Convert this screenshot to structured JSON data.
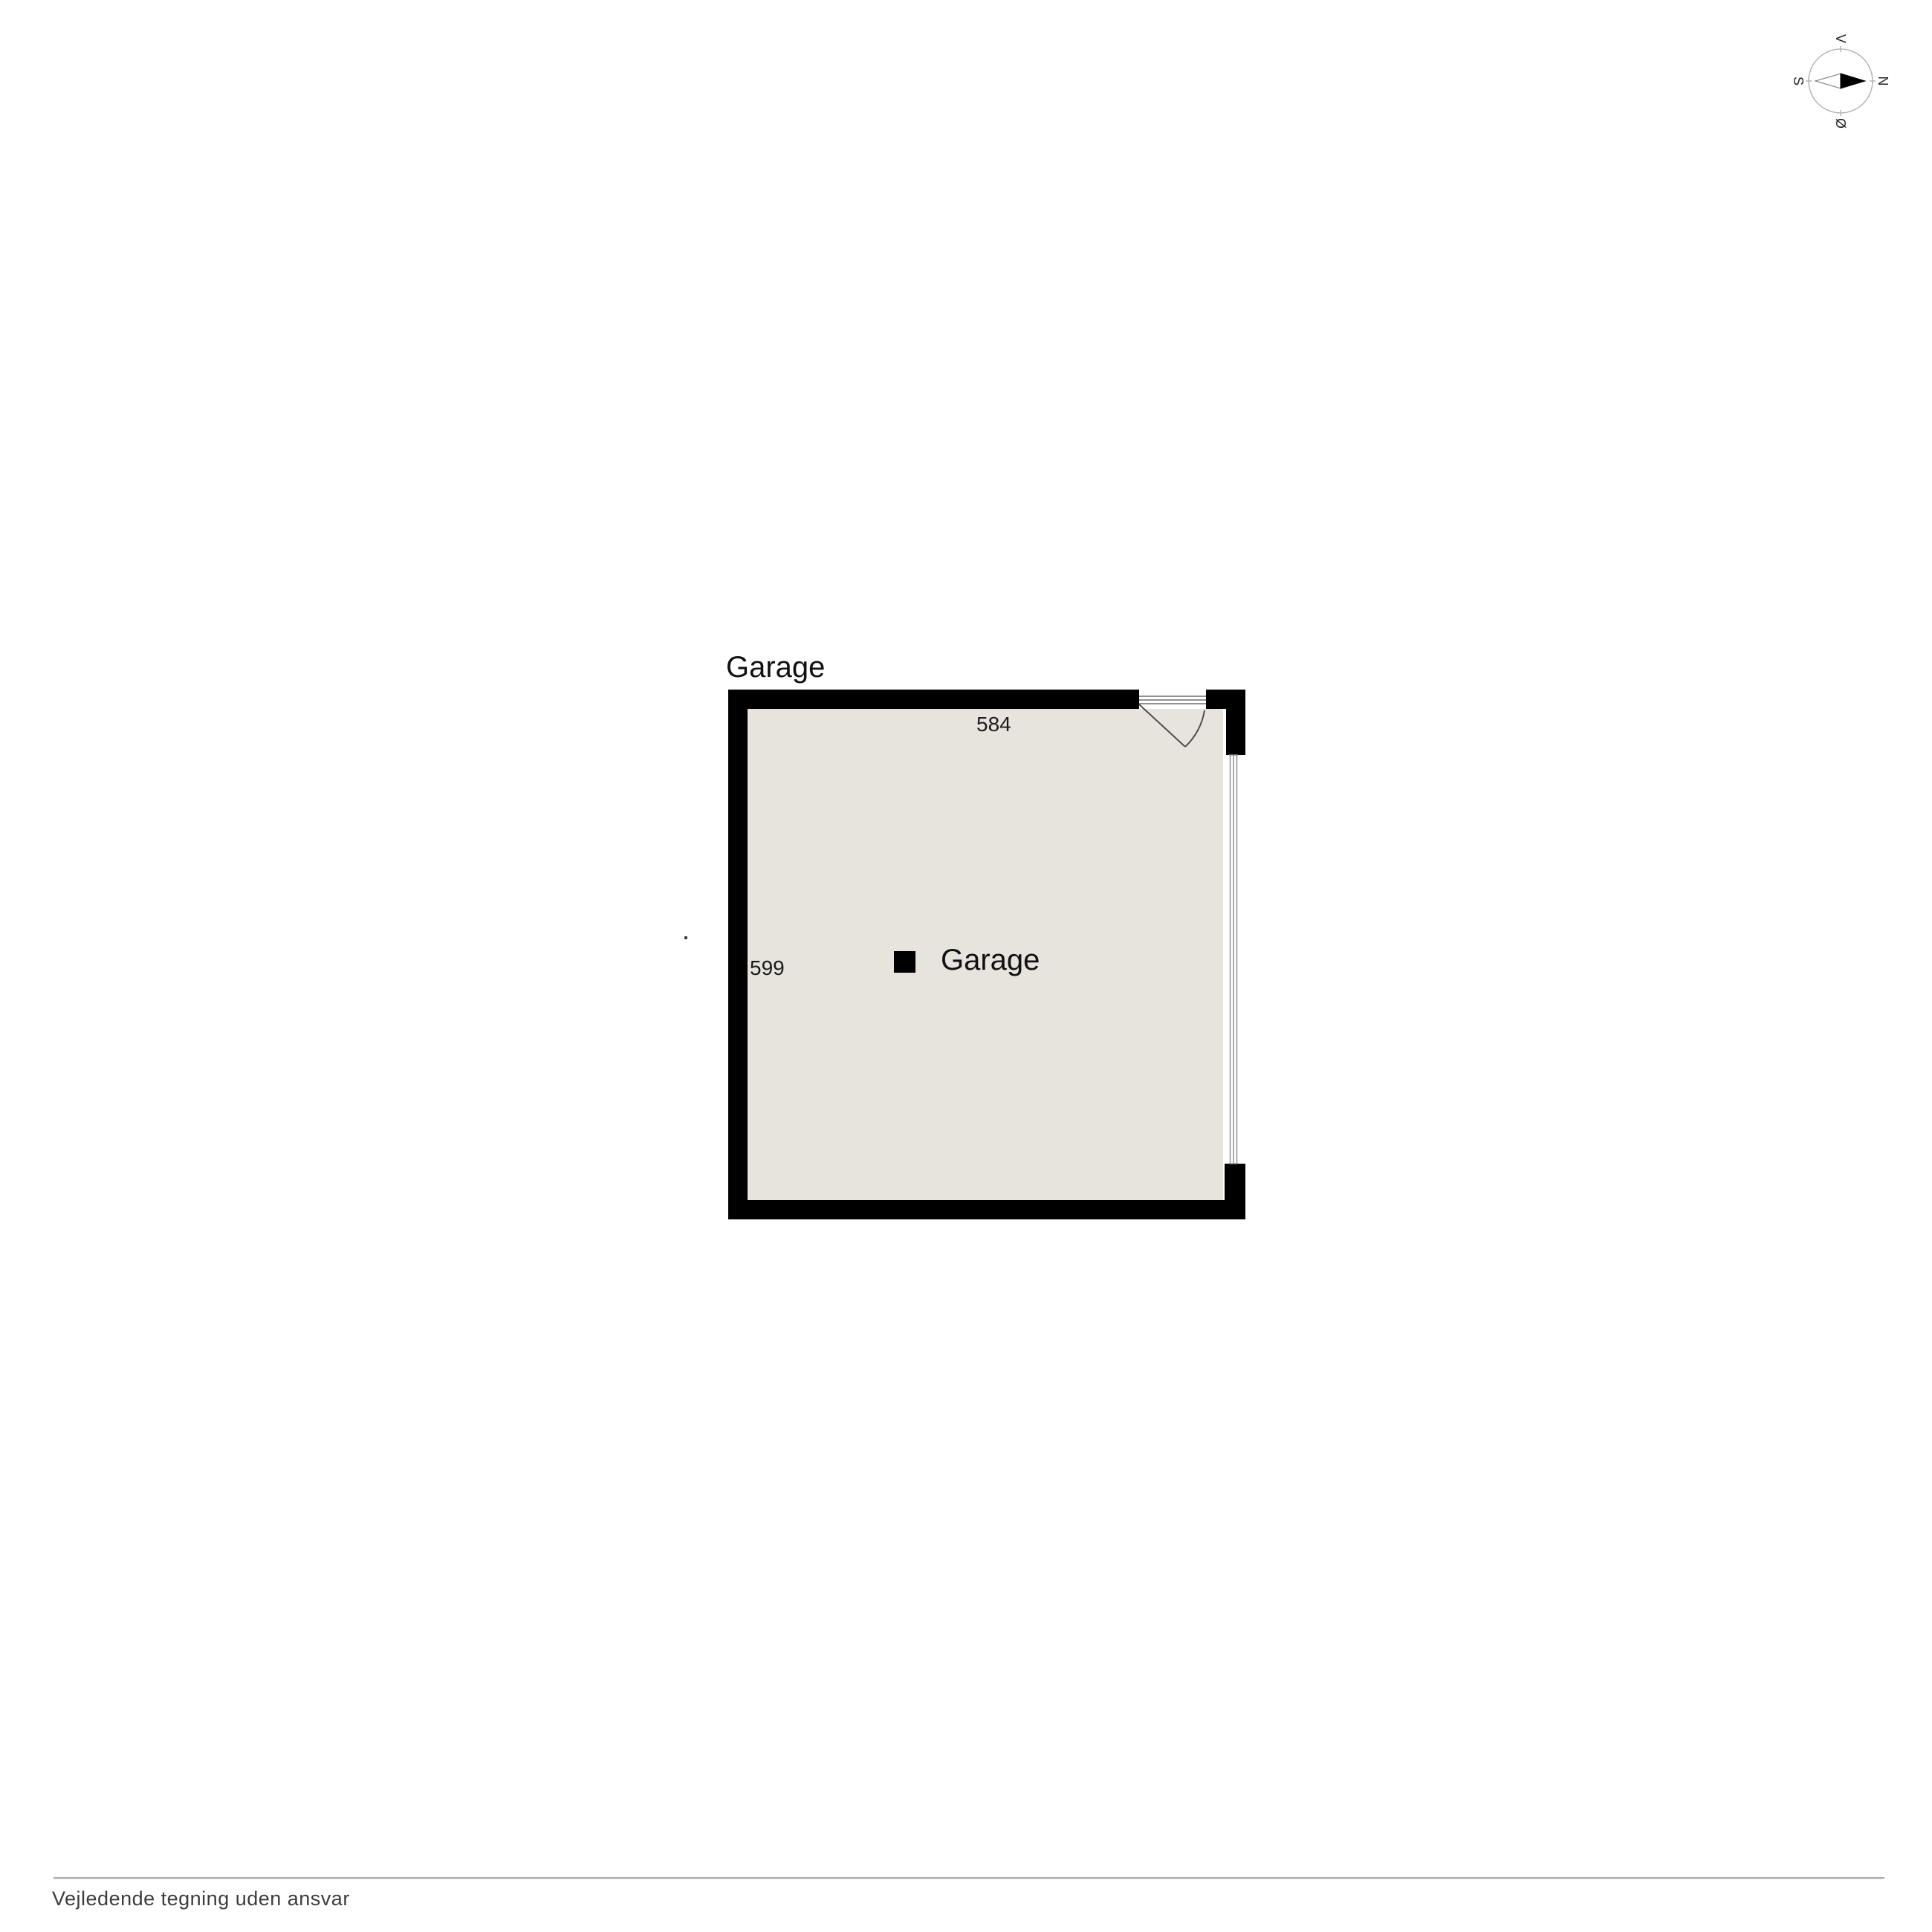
{
  "compass": {
    "labels": {
      "top": "V",
      "right": "N",
      "left": "S",
      "bottom": "Ø"
    },
    "needle_points": "right"
  },
  "floorplan": {
    "title": "Garage",
    "room": {
      "label": "Garage",
      "width_dim": "584",
      "height_dim": "599"
    }
  },
  "footer": {
    "disclaimer": "Vejledende tegning uden ansvar"
  },
  "colors": {
    "wall": "#000000",
    "floor": "#e7e3dd",
    "door_line": "#4f4f4f",
    "garage_door_line": "#8a8a8a",
    "compass_ring": "#b5b5b5",
    "footer_line": "#b3b3b3",
    "footer_text": "#3c3c3c"
  }
}
